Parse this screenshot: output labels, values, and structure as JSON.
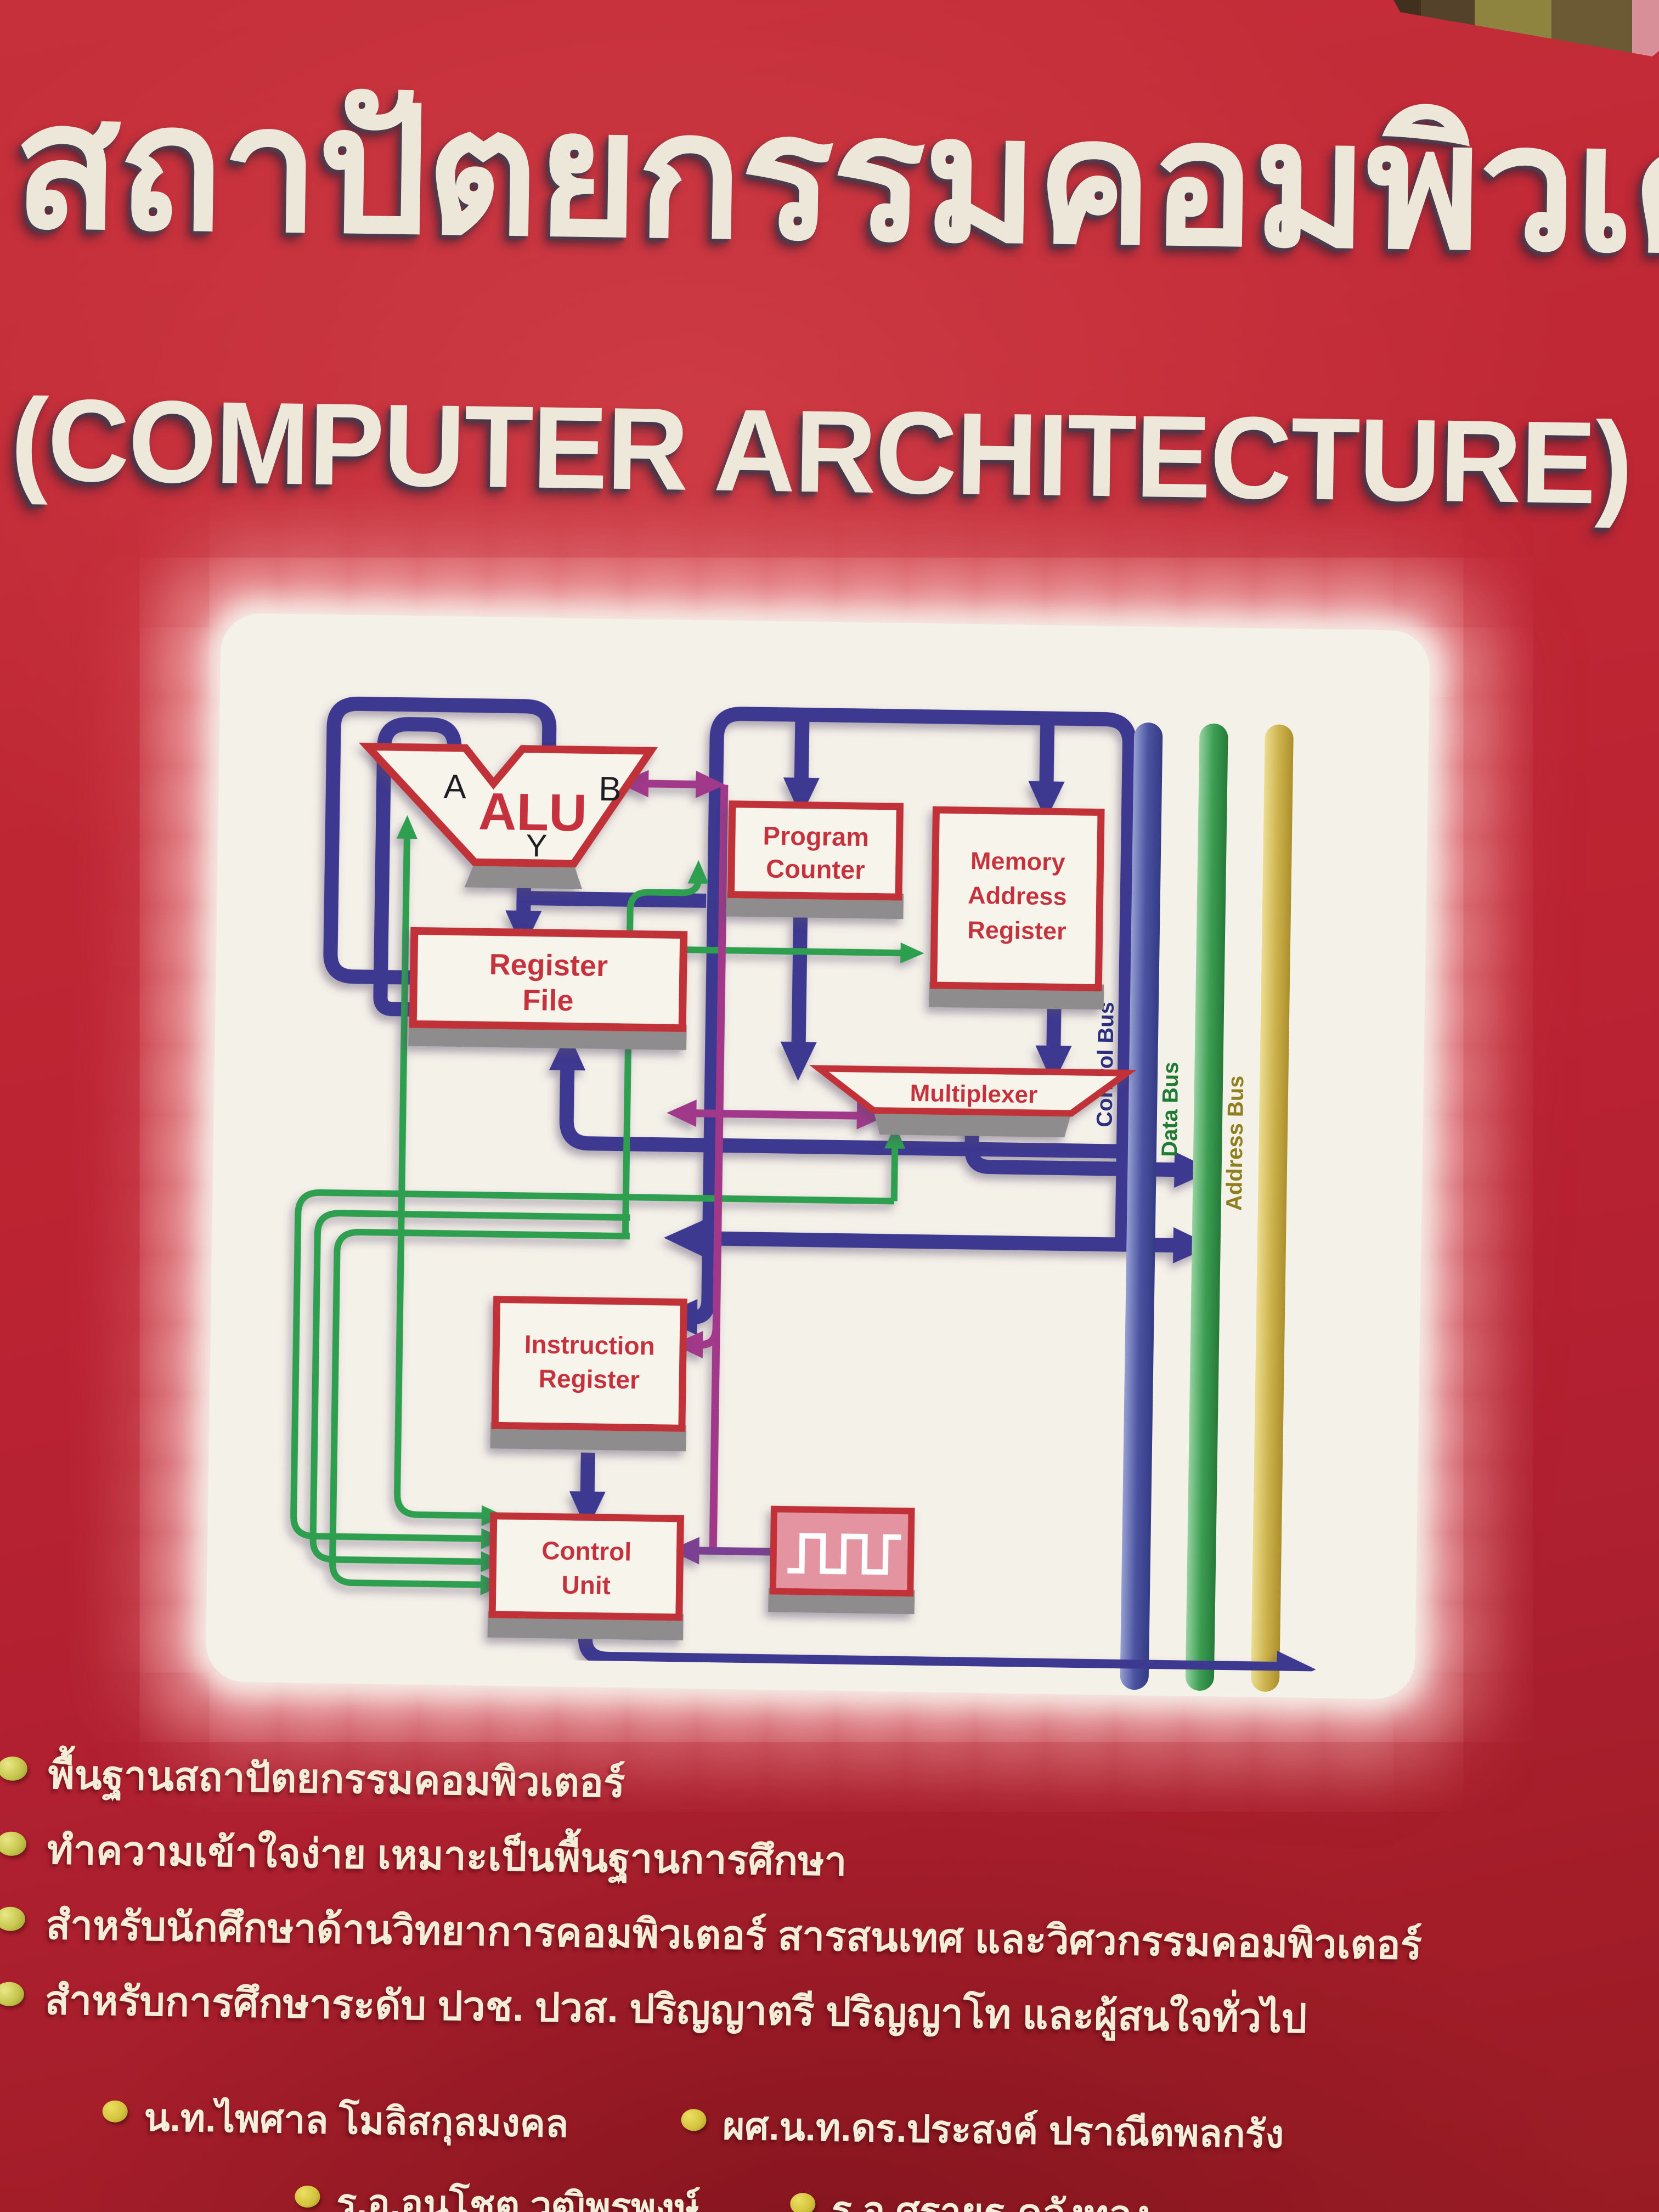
{
  "cover": {
    "title_thai": "สถาปัตยกรรมคอมพิวเตอร์",
    "subtitle_english": "(COMPUTER ARCHITECTURE)",
    "features": [
      "พื้นฐานสถาปัตยกรรมคอมพิวเตอร์",
      "ทำความเข้าใจง่าย เหมาะเป็นพื้นฐานการศึกษา",
      "สำหรับนักศึกษาด้านวิทยาการคอมพิวเตอร์ สารสนเทศ และวิศวกรรมคอมพิวเตอร์",
      "สำหรับการศึกษาระดับ ปวช. ปวส. ปริญญาตรี ปริญญาโท และผู้สนใจทั่วไป"
    ],
    "authors": [
      "น.ท.ไพศาล  โมลิสกุลมงคล",
      "ผศ.น.ท.ดร.ประสงค์  ปราณีตพลกรัง",
      "ร.อ.อนุโชต  วุฒิพรพงษ์",
      "ร.อ.ศรายุธ  คลังทอง"
    ],
    "colors": {
      "cover_red": "#bb2332",
      "title_cream": "#ece7d9",
      "panel_white": "#f4f1e8",
      "bullet_green": "#c6c64e",
      "bullet_yellow": "#d3c23c"
    }
  },
  "diagram": {
    "blocks": {
      "alu": {
        "label": "ALU",
        "port_a": "A",
        "port_b": "B",
        "port_y": "Y"
      },
      "program_counter": {
        "line1": "Program",
        "line2": "Counter"
      },
      "memory_address_register": {
        "line1": "Memory",
        "line2": "Address",
        "line3": "Register"
      },
      "register_file": {
        "line1": "Register",
        "line2": "File"
      },
      "multiplexer": {
        "label": "Multiplexer"
      },
      "instruction_register": {
        "line1": "Instruction",
        "line2": "Register"
      },
      "control_unit": {
        "line1": "Control",
        "line2": "Unit"
      },
      "clock": {
        "icon": "square-wave-icon"
      }
    },
    "buses": [
      {
        "label": "Control Bus",
        "color": "#3a418f"
      },
      {
        "label": "Data Bus",
        "color": "#2f8f45"
      },
      {
        "label": "Address Bus",
        "color": "#bfa433"
      }
    ],
    "arrow_colors": {
      "data_path_navy": "#3c3890",
      "control_signal_green": "#2f9e4f",
      "transfer_magenta": "#a1398a",
      "clock_purple": "#7b3f92"
    }
  }
}
